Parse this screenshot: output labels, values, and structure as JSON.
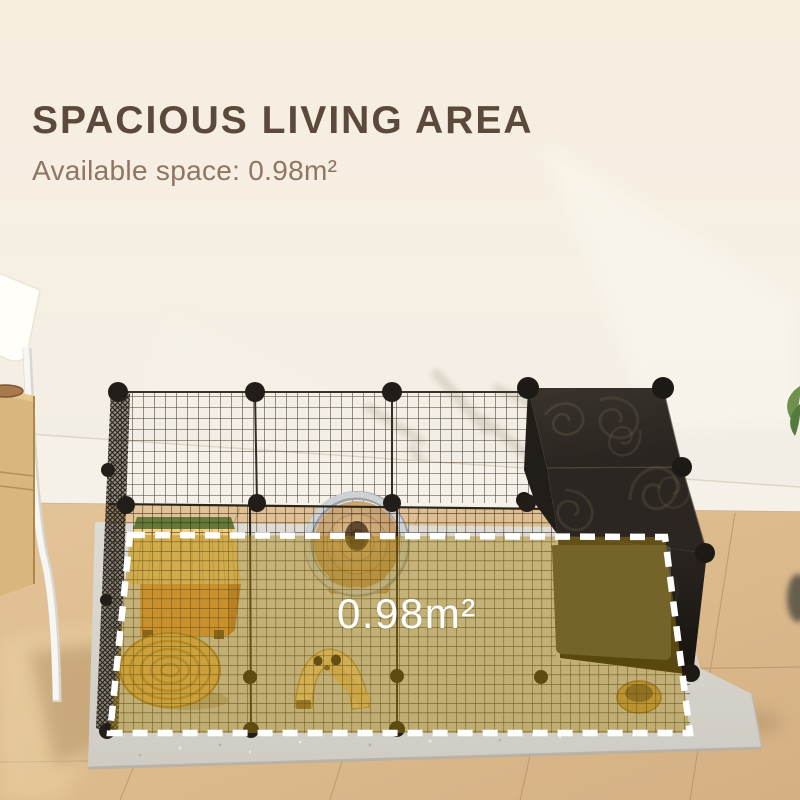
{
  "page": {
    "background_color": "#f6efe3"
  },
  "header": {
    "title": "SPACIOUS LIVING AREA",
    "title_color": "#5b4a3b",
    "subtitle": "Available space: 0.98m²",
    "subtitle_color": "#8f7563"
  },
  "highlight": {
    "area_label": "0.98m²",
    "label_color": "#ffffff",
    "fill_color": "#a8860f",
    "border_color": "#ffffff",
    "border_style": "dashed"
  },
  "scene": {
    "objects": [
      "floor-lamp",
      "side-table",
      "wood-floor",
      "baseboard",
      "floor-mat",
      "wire-playpen",
      "black-panel-enclosure",
      "hideout-house",
      "hamster-wheel",
      "wicker-mat",
      "wooden-slide",
      "food-bowl",
      "plant-leaves"
    ]
  }
}
